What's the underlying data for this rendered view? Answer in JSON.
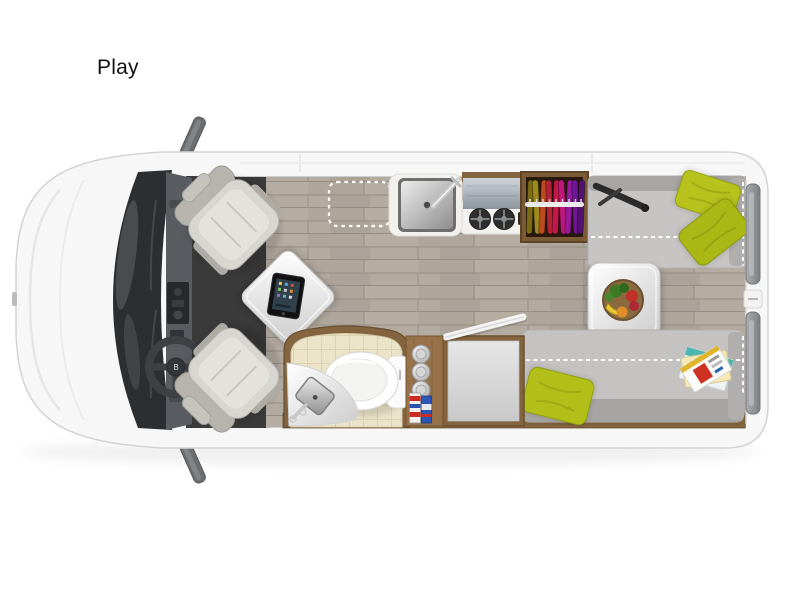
{
  "page": {
    "background_color": "#ffffff",
    "label": "Play"
  },
  "floorplan": {
    "name": "Play",
    "view": "top-down camper van floor plan",
    "steering_badge": "B",
    "colors": {
      "van_body": "#f7f7f7",
      "van_outline": "#d4d4d4",
      "windshield": "#2c2f31",
      "cab_floor": "#3a3a3b",
      "wood_floor": "#b3aba0",
      "wood_trim": "#84643f",
      "bench_fabric": "#c6c5c3",
      "pillow_green": "#b4c01b",
      "bathroom_tile": "#ece4c8",
      "counter_white": "#f3f1ee",
      "stove_gray": "#a7b0b7",
      "seat_gray": "#d8d6d1"
    },
    "elements": [
      {
        "name": "van-body"
      },
      {
        "name": "side-mirrors"
      },
      {
        "name": "windshield"
      },
      {
        "name": "dashboard"
      },
      {
        "name": "steering-wheel"
      },
      {
        "name": "driver-seat"
      },
      {
        "name": "passenger-seat"
      },
      {
        "name": "front-table"
      },
      {
        "name": "tablet"
      },
      {
        "name": "optional-feature-outline"
      },
      {
        "name": "kitchen-sink"
      },
      {
        "name": "stove"
      },
      {
        "name": "wardrobe"
      },
      {
        "name": "rear-sofa-top"
      },
      {
        "name": "rear-sofa-bottom"
      },
      {
        "name": "dinette-table"
      },
      {
        "name": "fruit-bowl"
      },
      {
        "name": "green-pillows"
      },
      {
        "name": "magazines"
      },
      {
        "name": "cabinet"
      },
      {
        "name": "bathroom"
      },
      {
        "name": "toilet"
      },
      {
        "name": "bathroom-sink"
      },
      {
        "name": "storage-shelf"
      },
      {
        "name": "rear-doors"
      }
    ]
  }
}
